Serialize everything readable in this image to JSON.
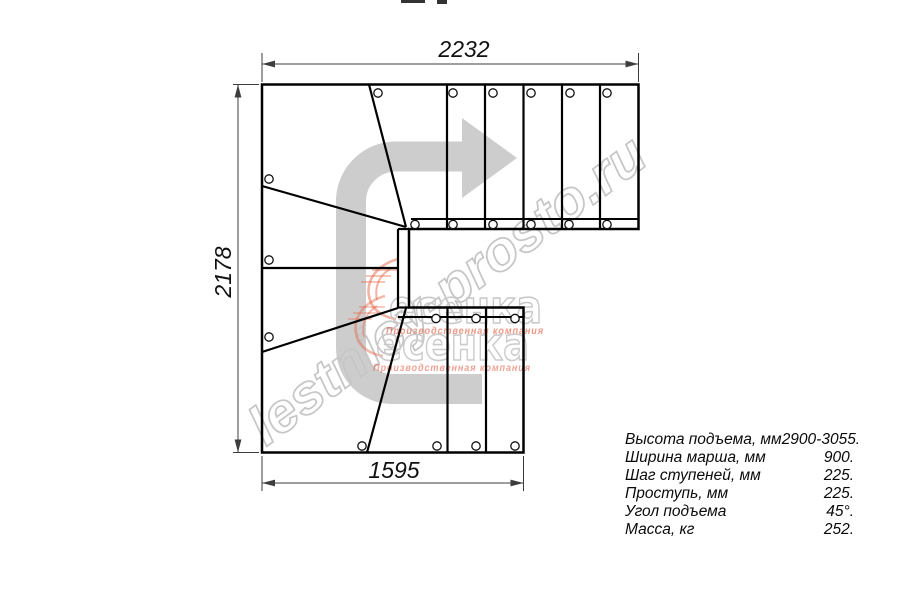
{
  "dimensions": {
    "top": "2232",
    "left": "2178",
    "bottom": "1595"
  },
  "specs": [
    {
      "label": "Высота подъема, мм",
      "value": "2900-3055."
    },
    {
      "label": "Ширина марша, мм",
      "value": "900."
    },
    {
      "label": "Шаг ступеней, мм",
      "value": "225."
    },
    {
      "label": "Проступь, мм",
      "value": "225."
    },
    {
      "label": "Угол подъема",
      "value": "45°."
    },
    {
      "label": "Масса, кг",
      "value": "252."
    }
  ],
  "watermark": {
    "site": "lestnicy-prosto.ru",
    "logo_text": "есенка",
    "logo_subtext": "Производственная компания"
  },
  "colors": {
    "line": "#000000",
    "dim": "#3d3d3d",
    "arrow": "#cdcdcd",
    "watermark": "#c6c6c6",
    "logo_accent": "#e2583e"
  }
}
